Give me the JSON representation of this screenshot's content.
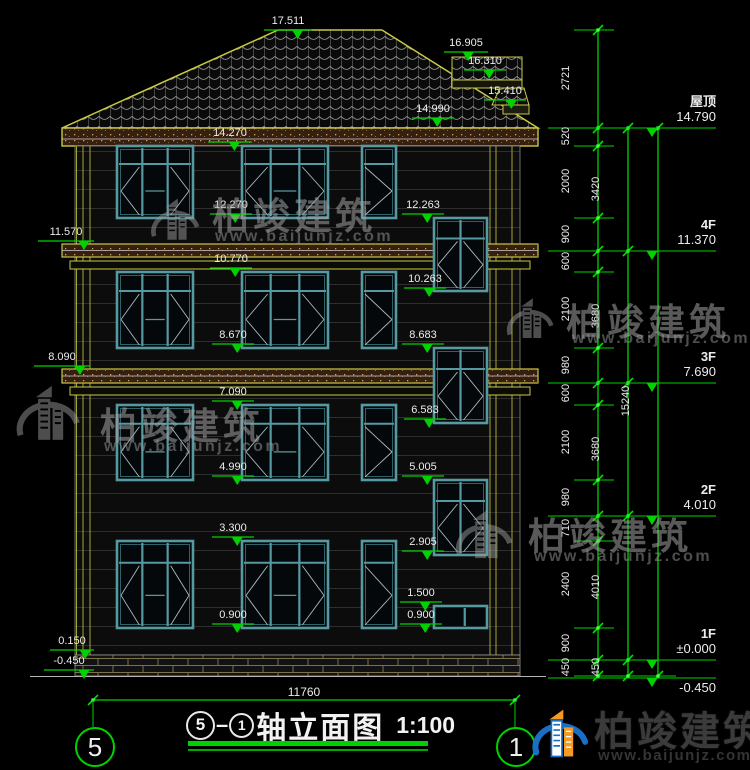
{
  "drawing": {
    "title_axis_start": "5",
    "title_axis_end": "1",
    "title_text": "轴立面图",
    "title_scale": "1:100",
    "axis_bubble_left": "5",
    "axis_bubble_right": "1"
  },
  "brand": {
    "name": "柏竣建筑",
    "url": "www.baijunjz.com"
  },
  "colors": {
    "cad_green": "#00d200",
    "cad_green_bright": "#49ff49",
    "cad_yellow": "#c9c943",
    "window_teal": "#5699a1",
    "band_brown": "#371f10",
    "text_white": "#ececec"
  },
  "floor_labels": [
    {
      "name": "屋顶",
      "elev": "14.790",
      "y": 128,
      "below": false
    },
    {
      "name": "4F",
      "elev": "11.370",
      "y": 251,
      "below": false
    },
    {
      "name": "3F",
      "elev": "7.690",
      "y": 383,
      "below": false
    },
    {
      "name": "2F",
      "elev": "4.010",
      "y": 516,
      "below": false
    },
    {
      "name": "1F",
      "elev": "±0.000",
      "y": 660,
      "below": false
    },
    {
      "name": "",
      "elev": "-0.450",
      "y": 678,
      "below": true
    }
  ],
  "elevation_markers": [
    {
      "t": "17.511",
      "x": 264,
      "y": 30,
      "w": 48,
      "f": 0.7
    },
    {
      "t": "16.905",
      "x": 444,
      "y": 52,
      "w": 44,
      "f": 0.55
    },
    {
      "t": "16.310",
      "x": 464,
      "y": 70,
      "w": 42,
      "f": 0.6
    },
    {
      "t": "15.410",
      "x": 484,
      "y": 100,
      "w": 42,
      "f": 0.65
    },
    {
      "t": "14.990",
      "x": 412,
      "y": 118,
      "w": 42,
      "f": 0.6
    },
    {
      "t": "14.270",
      "x": 208,
      "y": 142,
      "w": 44,
      "f": 0.6
    },
    {
      "t": "12.270",
      "x": 210,
      "y": 214,
      "w": 42,
      "f": 0.6
    },
    {
      "t": "12.263",
      "x": 402,
      "y": 214,
      "w": 42,
      "f": 0.6
    },
    {
      "t": "10.770",
      "x": 210,
      "y": 268,
      "w": 42,
      "f": 0.6
    },
    {
      "t": "10.263",
      "x": 404,
      "y": 288,
      "w": 42,
      "f": 0.6
    },
    {
      "t": "8.670",
      "x": 212,
      "y": 344,
      "w": 42,
      "f": 0.6
    },
    {
      "t": "8.683",
      "x": 402,
      "y": 344,
      "w": 42,
      "f": 0.6
    },
    {
      "t": "7.090",
      "x": 212,
      "y": 401,
      "w": 42,
      "f": 0.6
    },
    {
      "t": "6.583",
      "x": 404,
      "y": 419,
      "w": 42,
      "f": 0.6
    },
    {
      "t": "4.990",
      "x": 212,
      "y": 476,
      "w": 42,
      "f": 0.6
    },
    {
      "t": "5.005",
      "x": 402,
      "y": 476,
      "w": 42,
      "f": 0.6
    },
    {
      "t": "3.300",
      "x": 212,
      "y": 537,
      "w": 42,
      "f": 0.6
    },
    {
      "t": "2.905",
      "x": 402,
      "y": 551,
      "w": 42,
      "f": 0.6
    },
    {
      "t": "1.500",
      "x": 400,
      "y": 602,
      "w": 42,
      "f": 0.6
    },
    {
      "t": "0.900",
      "x": 212,
      "y": 624,
      "w": 42,
      "f": 0.6
    },
    {
      "t": "0.900",
      "x": 400,
      "y": 624,
      "w": 42,
      "f": 0.6
    },
    {
      "t": "11.570",
      "x": 38,
      "y": 241,
      "w": 56,
      "f": 0.82
    },
    {
      "t": "8.090",
      "x": 34,
      "y": 366,
      "w": 56,
      "f": 0.82
    },
    {
      "t": "0.150",
      "x": 50,
      "y": 650,
      "w": 44,
      "f": 0.8
    },
    {
      "t": "-0.450",
      "x": 44,
      "y": 670,
      "w": 50,
      "f": 0.8
    }
  ],
  "dim_columns": [
    {
      "x": 598,
      "stub": [
        574,
        614
      ],
      "ticks": [
        30,
        128,
        146,
        218,
        251,
        272,
        348,
        383,
        405,
        480,
        516,
        541,
        628,
        660,
        676
      ],
      "labels": [
        "2721",
        "520",
        "2000",
        "900",
        "600",
        "2100",
        "980",
        "600",
        "2100",
        "980",
        "710",
        "2400",
        "900",
        "450"
      ]
    },
    {
      "x": 628,
      "stub": [
        606,
        644
      ],
      "ticks": [
        128,
        251,
        383,
        516,
        660,
        676
      ],
      "labels": [
        "3420",
        "3680",
        "3680",
        "4010",
        "450"
      ]
    },
    {
      "x": 658,
      "stub": [
        638,
        676
      ],
      "ticks": [
        128,
        676
      ],
      "labels": [
        "15240"
      ]
    }
  ],
  "bottom_dim": {
    "label": "11760",
    "y": 700,
    "x1": 93,
    "x2": 515,
    "bubble_y": 746,
    "r": 19
  },
  "windows": [
    {
      "x": 117,
      "y": 146,
      "w": 76,
      "h": 72,
      "t": "w3"
    },
    {
      "x": 242,
      "y": 146,
      "w": 86,
      "h": 72,
      "t": "w3"
    },
    {
      "x": 362,
      "y": 146,
      "w": 34,
      "h": 72,
      "t": "w1"
    },
    {
      "x": 117,
      "y": 272,
      "w": 76,
      "h": 76,
      "t": "w3"
    },
    {
      "x": 242,
      "y": 272,
      "w": 86,
      "h": 76,
      "t": "w3"
    },
    {
      "x": 362,
      "y": 272,
      "w": 34,
      "h": 76,
      "t": "w1"
    },
    {
      "x": 117,
      "y": 405,
      "w": 76,
      "h": 75,
      "t": "w3"
    },
    {
      "x": 242,
      "y": 405,
      "w": 86,
      "h": 75,
      "t": "w3"
    },
    {
      "x": 362,
      "y": 405,
      "w": 34,
      "h": 75,
      "t": "w1"
    },
    {
      "x": 117,
      "y": 541,
      "w": 76,
      "h": 87,
      "t": "w3"
    },
    {
      "x": 242,
      "y": 541,
      "w": 86,
      "h": 87,
      "t": "w3"
    },
    {
      "x": 362,
      "y": 541,
      "w": 34,
      "h": 87,
      "t": "w1"
    },
    {
      "x": 434,
      "y": 218,
      "w": 53,
      "h": 73,
      "t": "s2"
    },
    {
      "x": 434,
      "y": 348,
      "w": 53,
      "h": 75,
      "t": "s2"
    },
    {
      "x": 434,
      "y": 480,
      "w": 53,
      "h": 75,
      "t": "s2"
    },
    {
      "x": 434,
      "y": 606,
      "w": 53,
      "h": 22,
      "t": "sl"
    }
  ],
  "watermarks": [
    {
      "icon": [
        146,
        178,
        58,
        84
      ],
      "brand": [
        212,
        186
      ],
      "url": [
        215,
        228
      ]
    },
    {
      "icon": [
        502,
        284,
        56,
        70
      ],
      "brand": [
        566,
        292
      ],
      "url": [
        572,
        330
      ]
    },
    {
      "icon": [
        10,
        366,
        76,
        96
      ],
      "brand": [
        100,
        396
      ],
      "url": [
        104,
        438
      ]
    },
    {
      "icon": [
        450,
        496,
        68,
        78
      ],
      "brand": [
        528,
        506
      ],
      "url": [
        534,
        548
      ]
    }
  ]
}
